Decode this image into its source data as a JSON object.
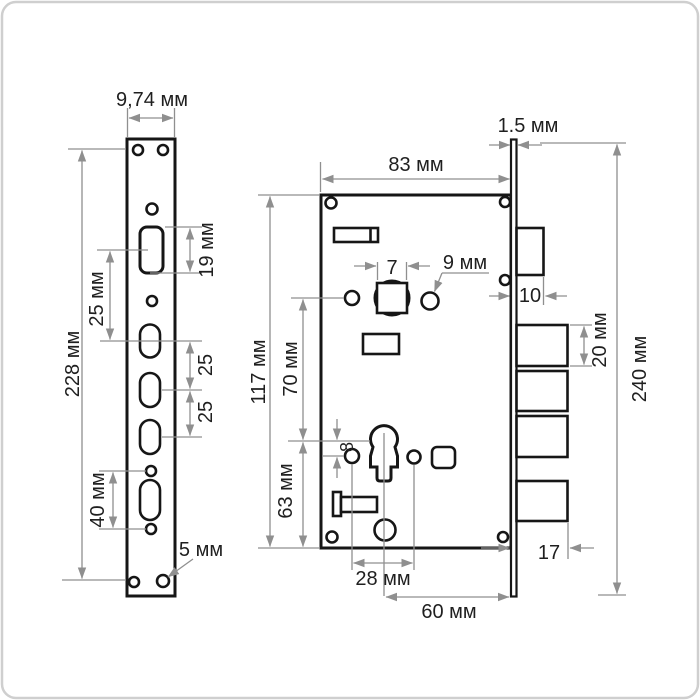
{
  "drawing": {
    "subject": "Mortise door lock technical drawing with dimensions",
    "views": [
      "faceplate front view",
      "lock body front view",
      "faceplate side view with bolts"
    ],
    "units": "мм"
  },
  "colors": {
    "outline": "#161616",
    "dimension_lines": "#8f8f8f",
    "label_text": "#1f1f1f",
    "background": "#ffffff",
    "frame": "#cfcfcf"
  },
  "labels": {
    "faceplate_width": "9,74 мм",
    "faceplate_height": "228 мм",
    "slot_to_oval_spacing": "25 мм",
    "latch_slot_height": "19 мм",
    "oval_gap_1": "25",
    "oval_gap_2": "25",
    "lower_hole_spacing": "40 мм",
    "screw_hole_diameter": "5 мм",
    "body_width": "83 мм",
    "plate_thickness": "1.5 мм",
    "spindle_square": "7",
    "cylinder_hole_diameter": "9 мм",
    "body_height": "117 мм",
    "spindle_to_keyhole": "70 мм",
    "keyhole_to_bottom": "63 мм",
    "keyhole_offset": "8",
    "keyhole_hole_spacing": "28 мм",
    "backset": "60 мм",
    "latch_throw": "10",
    "bolt_height": "20 мм",
    "total_height": "240 мм",
    "bolt_throw": "17"
  }
}
